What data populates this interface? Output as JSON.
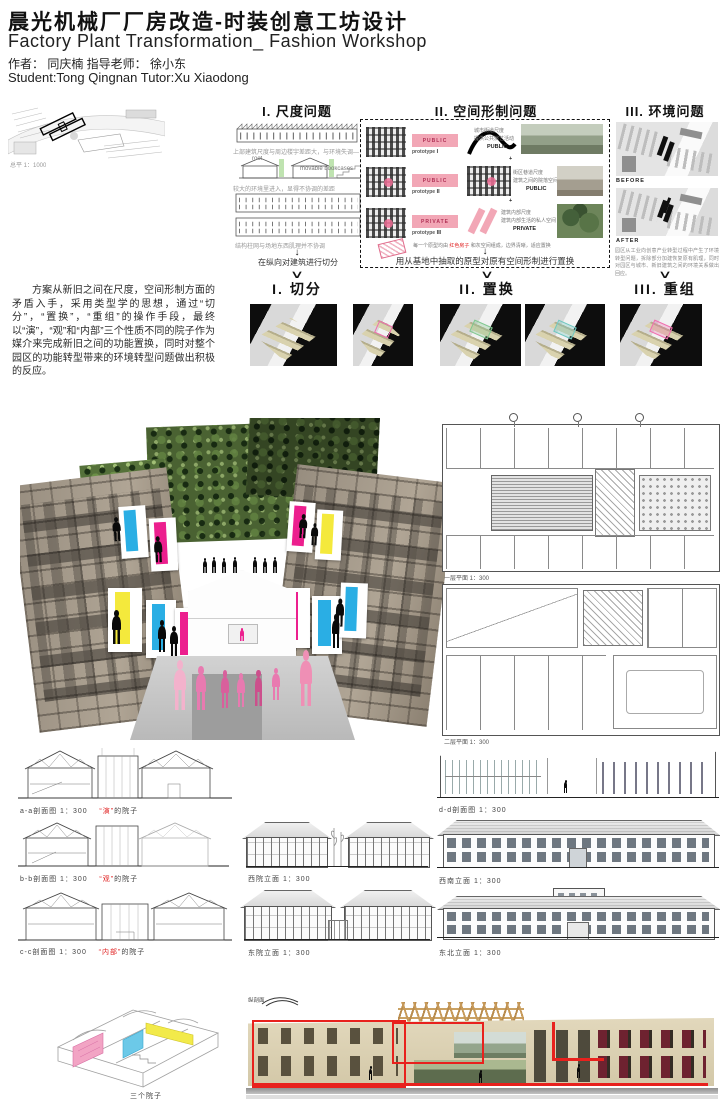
{
  "header": {
    "title_cn": "晨光机械厂厂房改造-时装创意工坊设计",
    "title_en": "Factory Plant Transformation_ Fashion Workshop",
    "author_line": "作者： 同庆楠   指导老师： 徐小东",
    "student_line": "Student:Tong Qingnan  Tutor:Xu Xiaodong"
  },
  "arrows": {
    "down": "↓",
    "chevron": "∨"
  },
  "site_plan": {
    "label": "总平  1：1000"
  },
  "problems": {
    "scale": {
      "title": "I. 尺度问题",
      "captions": [
        "上部建筑尺度与周边楼宇差距大，与环境失调—",
        "较大的环境里进入，显得不协调的差距",
        "结构柱网与场地东西肌理并不协调"
      ],
      "roof_label": "roof",
      "bookcase_label": "movable bookcases",
      "arrow_caption": "在纵向对建筑进行切分"
    },
    "form": {
      "title": "II. 空间形制问题",
      "badges": [
        {
          "label": "PUBLIC",
          "sub": "prototype Ⅰ"
        },
        {
          "label": "PUBLIC",
          "sub": "prototype Ⅱ"
        },
        {
          "label": "PRIVATE",
          "sub": "prototype Ⅲ"
        }
      ],
      "notes": [
        {
          "l1": "城市街道尺度",
          "l2": "提供公共演艺活动",
          "tag": "PUBLIC"
        },
        {
          "l1": "街区巷道尺度",
          "l2": "建筑之间的院落空间",
          "tag": "PUBLIC"
        },
        {
          "l1": "建筑内部尺度",
          "l2": "建筑内部生活的私人空间",
          "tag": "PRIVATE"
        }
      ],
      "plus": "+",
      "stamp": {
        "pre": "每一个原型均由 ",
        "red": "红色房子",
        "post": " 和灰空间组成，边界清晰，适应置换"
      },
      "arrow_caption": "用从基地中抽取的原型对原有空间形制进行置换"
    },
    "env": {
      "title": "III. 环境问题",
      "before_label": "BEFORE",
      "after_label": "AFTER",
      "caption": "园区从工业向创意产业转型过程中产生了环境转型问题，拆除部分加建恢复原有肌理，同时对园区与城市、新旧建筑之间的环境关系做出回应。"
    }
  },
  "strategies": {
    "cut": "I. 切分",
    "replace": "II. 置换",
    "regroup": "III. 重组"
  },
  "intro_paragraph": "方案从新旧之间在尺度，空间形制方面的矛盾入手，采用类型学的思想，通过“切分”，“置换”，“重组”的操作手段，最终以“演”，“观”和“内部”三个性质不同的院子作为媒介来完成新旧之间的功能置换，同时对整个园区的功能转型带来的环境转型问题做出积极的反应。",
  "plans": {
    "first_floor_label": "一层平面  1：300",
    "second_floor_label": "二层平面  1：300"
  },
  "sections_left": [
    {
      "label": "a-a剖面图  1：300",
      "red": "“演”",
      "suffix": "的院子"
    },
    {
      "label": "b-b剖面图  1：300",
      "red": "“观”",
      "suffix": "的院子"
    },
    {
      "label": "c-c剖面图  1：300",
      "red": "“内部”",
      "suffix": "的院子"
    }
  ],
  "elevations_mid": [
    {
      "label": "西院立面  1：300"
    },
    {
      "label": "东院立面  1：300"
    }
  ],
  "drawings_right": [
    {
      "label": "d-d剖面图  1：300"
    },
    {
      "label": "西南立面  1：300"
    },
    {
      "label": "东北立面  1：300"
    }
  ],
  "axon_caption": "三个院子",
  "long_section_tag": "纵剖面",
  "colors": {
    "magenta": "#ec1f8e",
    "cyan": "#2aaee4",
    "yellow": "#f4e93c",
    "pink_badge": "#f2a7b6",
    "red_line": "#e8211d",
    "people_pink": "#e87ab0",
    "model_beige": "#dcd2b4"
  }
}
